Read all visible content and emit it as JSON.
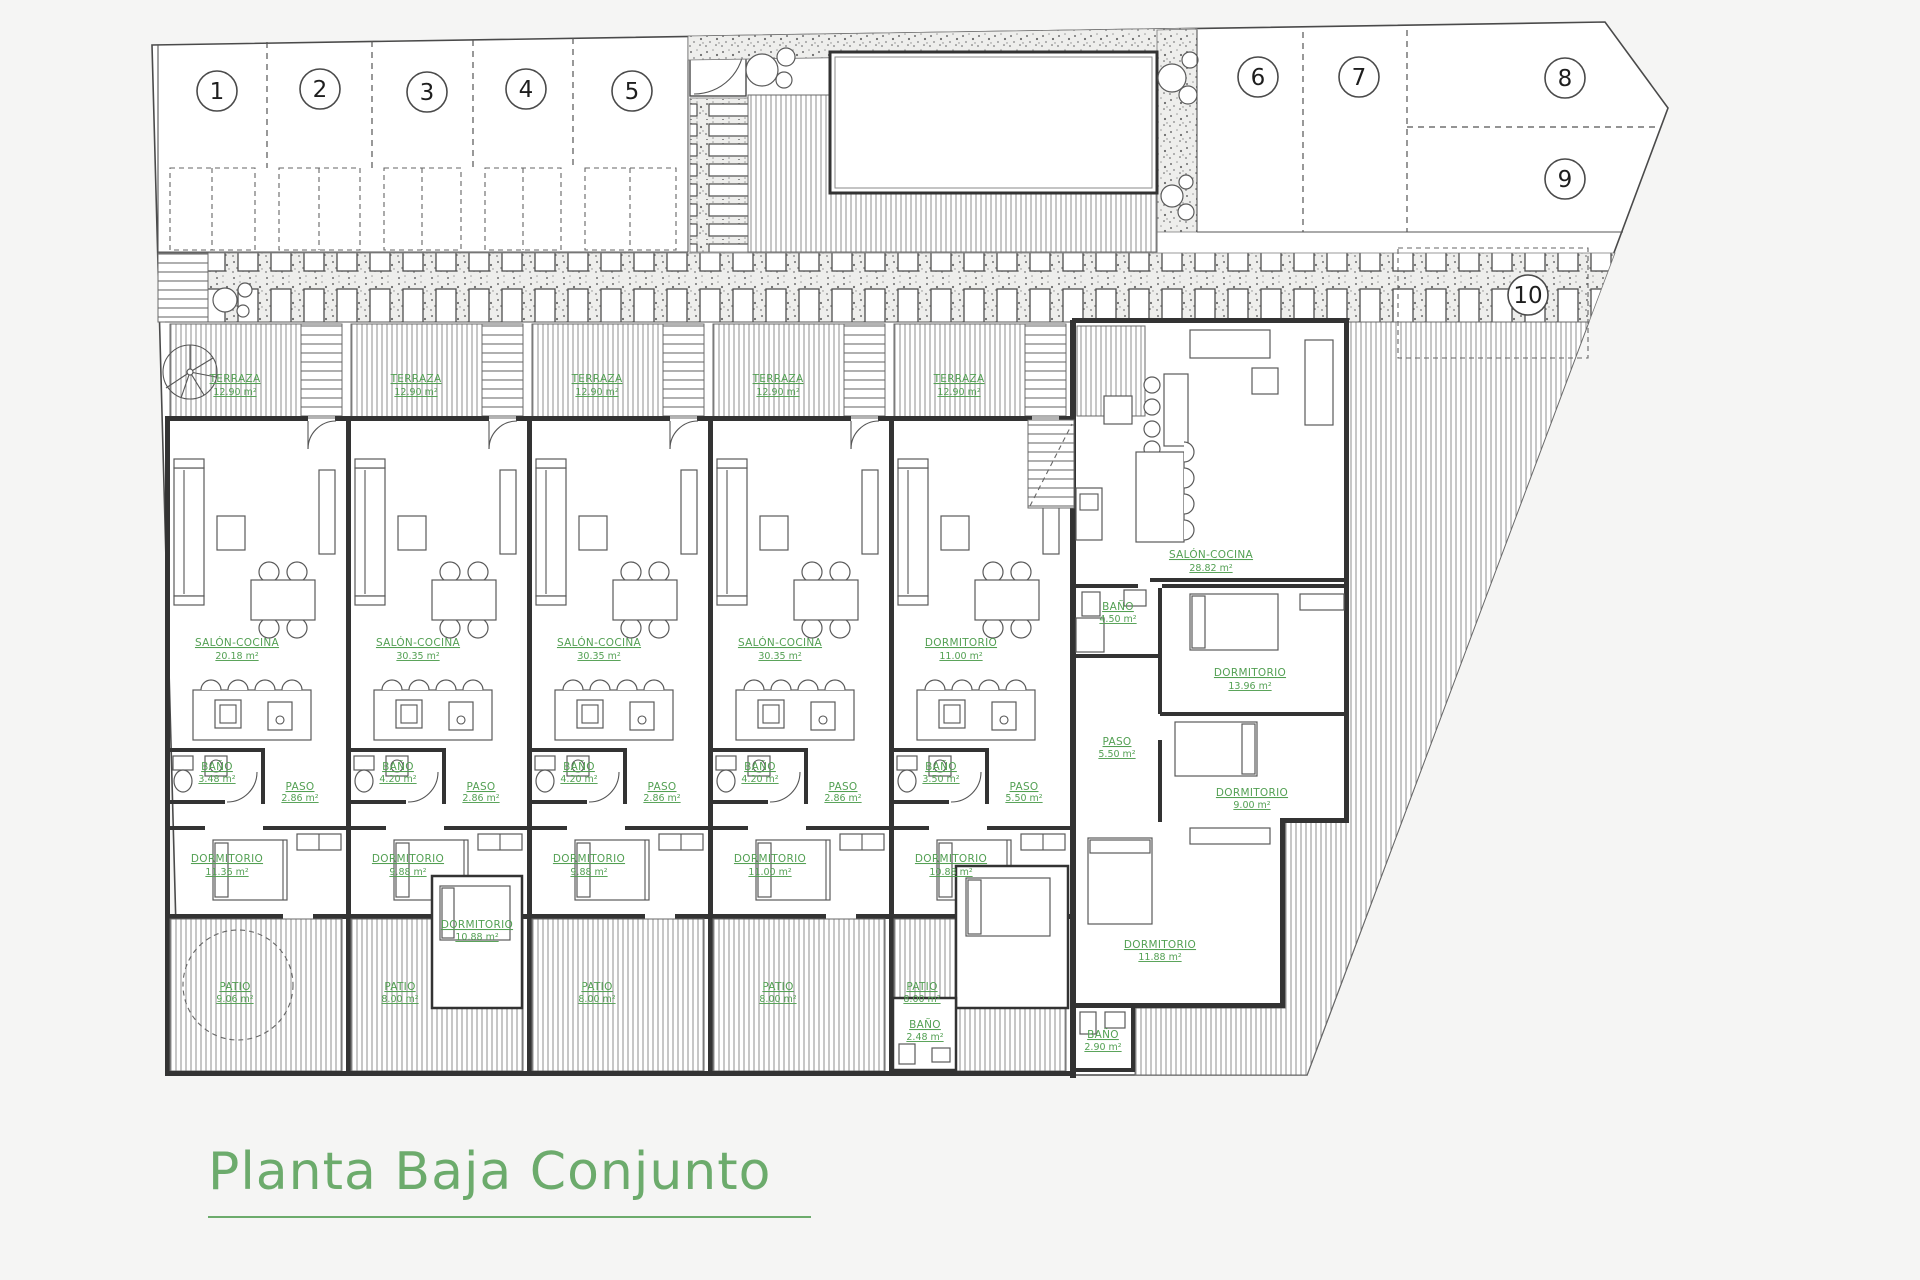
{
  "title": "Planta Baja Conjunto",
  "colors": {
    "label_green": "#53a053",
    "title_green": "#6cab6c",
    "line": "#333333"
  },
  "parking": {
    "numbers": [
      "1",
      "2",
      "3",
      "4",
      "5",
      "6",
      "7",
      "8",
      "9",
      "10"
    ]
  },
  "units": [
    {
      "terraza": {
        "name": "TERRAZA",
        "area": "12.90 m²"
      },
      "salon": {
        "name": "SALÓN-COCINA",
        "area": "20.18 m²"
      },
      "bano": {
        "name": "BAÑO",
        "area": "3.48 m²"
      },
      "paso": {
        "name": "PASO",
        "area": "2.86 m²"
      },
      "dormitorio": {
        "name": "DORMITORIO",
        "area": "11.36 m²"
      },
      "patio": {
        "name": "PATIO",
        "area": "9.06 m²"
      }
    },
    {
      "terraza": {
        "name": "TERRAZA",
        "area": "12.90 m²"
      },
      "salon": {
        "name": "SALÓN-COCINA",
        "area": "30.35 m²"
      },
      "bano": {
        "name": "BAÑO",
        "area": "4.20 m²"
      },
      "paso": {
        "name": "PASO",
        "area": "2.86 m²"
      },
      "dormitorio": {
        "name": "DORMITORIO",
        "area": "9.88 m²"
      },
      "dormitorio2": {
        "name": "DORMITORIO",
        "area": "10.88 m²"
      },
      "patio": {
        "name": "PATIO",
        "area": "8.00 m²"
      }
    },
    {
      "terraza": {
        "name": "TERRAZA",
        "area": "12.90 m²"
      },
      "salon": {
        "name": "SALÓN-COCINA",
        "area": "30.35 m²"
      },
      "bano": {
        "name": "BAÑO",
        "area": "4.20 m²"
      },
      "paso": {
        "name": "PASO",
        "area": "2.86 m²"
      },
      "dormitorio": {
        "name": "DORMITORIO",
        "area": "9.88 m²"
      },
      "patio": {
        "name": "PATIO",
        "area": "8.00 m²"
      }
    },
    {
      "terraza": {
        "name": "TERRAZA",
        "area": "12.90 m²"
      },
      "salon": {
        "name": "SALÓN-COCINA",
        "area": "30.35 m²"
      },
      "bano": {
        "name": "BAÑO",
        "area": "4.20 m²"
      },
      "paso": {
        "name": "PASO",
        "area": "2.86 m²"
      },
      "dormitorio": {
        "name": "DORMITORIO",
        "area": "11.00 m²"
      },
      "patio": {
        "name": "PATIO",
        "area": "8.00 m²"
      }
    },
    {
      "terraza": {
        "name": "TERRAZA",
        "area": "12.90 m²"
      },
      "salon": {
        "name": "DORMITORIO",
        "area": "11.00 m²"
      },
      "bano": {
        "name": "BAÑO",
        "area": "3.50 m²"
      },
      "paso": {
        "name": "PASO",
        "area": "5.50 m²"
      },
      "dormitorio": {
        "name": "DORMITORIO",
        "area": "10.88 m²"
      },
      "bano2": {
        "name": "BAÑO",
        "area": "2.48 m²"
      },
      "patio": {
        "name": "PATIO",
        "area": "8.00 m²"
      }
    }
  ],
  "main_house": {
    "salon": {
      "name": "SALÓN-COCINA",
      "area": "28.82 m²"
    },
    "bano1": {
      "name": "BAÑO",
      "area": "4.50 m²"
    },
    "dorm1": {
      "name": "DORMITORIO",
      "area": "13.96 m²"
    },
    "paso": {
      "name": "PASO",
      "area": "5.50 m²"
    },
    "dorm2": {
      "name": "DORMITORIO",
      "area": "9.00 m²"
    },
    "dorm3": {
      "name": "DORMITORIO",
      "area": "11.88 m²"
    },
    "bano2": {
      "name": "BAÑO",
      "area": "2.90 m²"
    }
  }
}
